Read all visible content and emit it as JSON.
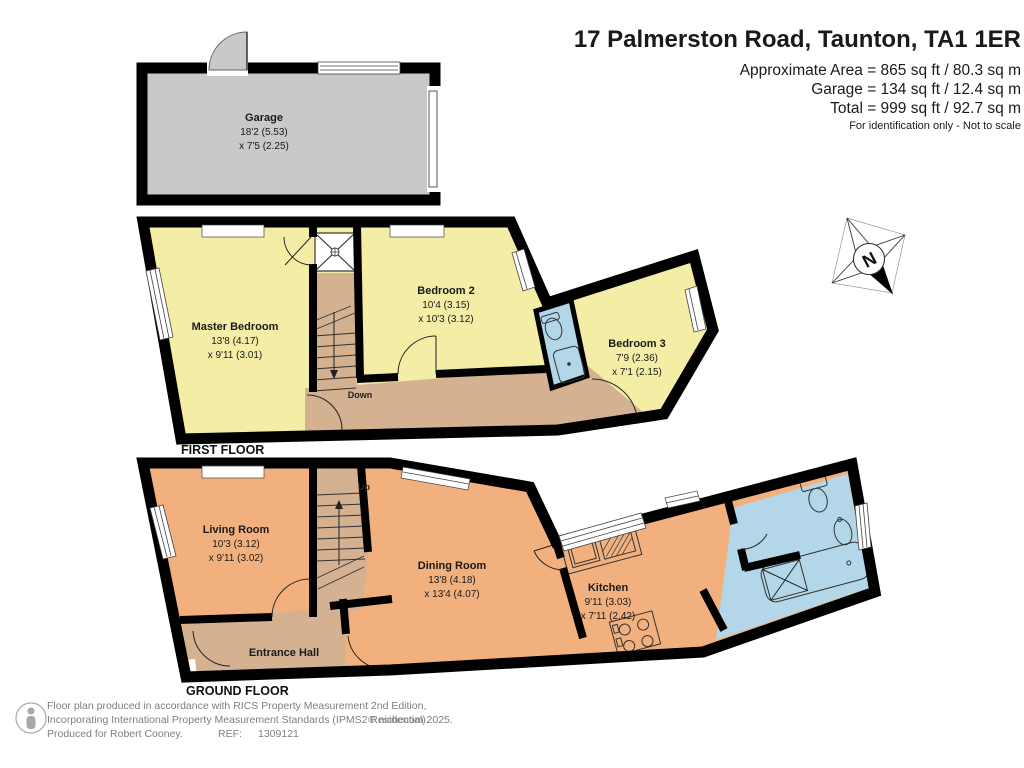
{
  "header": {
    "title": "17 Palmerston Road, Taunton, TA1 1ER",
    "approx_area": "Approximate Area = 865 sq ft / 80.3 sq m",
    "garage_area": "Garage = 134 sq ft / 12.4 sq m",
    "total_area": "Total = 999 sq ft / 92.7 sq m",
    "disclaimer": "For identification only - Not to scale"
  },
  "rooms": {
    "garage": {
      "name": "Garage",
      "d1": "18'2 (5.53)",
      "d2": "x 7'5 (2.25)"
    },
    "master_bedroom": {
      "name": "Master Bedroom",
      "d1": "13'8 (4.17)",
      "d2": "x 9'11 (3.01)"
    },
    "bedroom2": {
      "name": "Bedroom 2",
      "d1": "10'4 (3.15)",
      "d2": "x 10'3 (3.12)"
    },
    "bedroom3": {
      "name": "Bedroom 3",
      "d1": "7'9 (2.36)",
      "d2": "x 7'1 (2.15)"
    },
    "living_room": {
      "name": "Living Room",
      "d1": "10'3 (3.12)",
      "d2": "x 9'11 (3.02)"
    },
    "dining_room": {
      "name": "Dining Room",
      "d1": "13'8 (4.18)",
      "d2": "x 13'4 (4.07)"
    },
    "kitchen": {
      "name": "Kitchen",
      "d1": "9'11 (3.03)",
      "d2": "x 7'11 (2.42)"
    },
    "entrance_hall": {
      "name": "Entrance Hall"
    }
  },
  "floor_labels": {
    "first": "FIRST FLOOR",
    "ground": "GROUND FLOOR"
  },
  "stairs": {
    "down": "Down",
    "up": "Up"
  },
  "compass": {
    "north": "N"
  },
  "footer": {
    "line1": "Floor plan produced in accordance with RICS Property Measurement 2nd Edition,",
    "line2": "Incorporating International Property Measurement Standards (IPMS2 Residential).",
    "produced": "Produced for Robert Cooney.",
    "ref_label": "REF:",
    "ref_number": "1309121",
    "copyright": "© nichecom 2025."
  },
  "colors": {
    "wall": "#000000",
    "bedroom_fill": "#f3eda6",
    "ground_fill": "#f2b07e",
    "hall_fill": "#d3b191",
    "bathroom_fill": "#b3d7e8",
    "garage_fill": "#c9c9c9"
  }
}
